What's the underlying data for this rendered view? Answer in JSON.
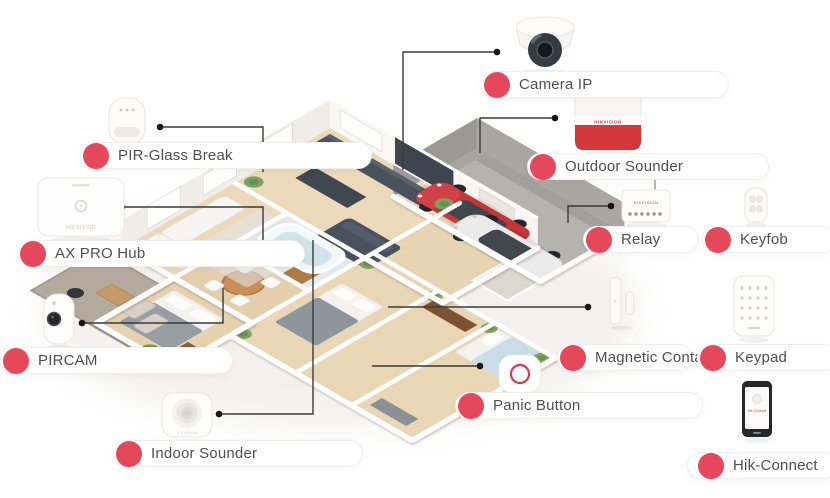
{
  "diagram": {
    "type": "smart-home-security-system-overview",
    "items": [
      {
        "id": "pir-glass-break",
        "label": "PIR-Glass Break",
        "icon": "motion-sensor-icon"
      },
      {
        "id": "ax-pro-hub",
        "label": "AX PRO Hub",
        "icon": "alarm-hub-icon",
        "brand": "HIKVISION"
      },
      {
        "id": "pircam",
        "label": "PIRCAM",
        "icon": "pir-camera-icon"
      },
      {
        "id": "indoor-sounder",
        "label": "Indoor Sounder",
        "icon": "indoor-siren-icon",
        "brand": "HIKVISION"
      },
      {
        "id": "camera-ip",
        "label": "Camera IP",
        "icon": "dome-camera-icon"
      },
      {
        "id": "outdoor-sounder",
        "label": "Outdoor Sounder",
        "icon": "outdoor-siren-icon",
        "brand": "HIKVISION"
      },
      {
        "id": "relay",
        "label": "Relay",
        "icon": "relay-module-icon",
        "brand": "HIKVISION"
      },
      {
        "id": "keyfob",
        "label": "Keyfob",
        "icon": "keyfob-remote-icon"
      },
      {
        "id": "magnetic-contact",
        "label": "Magnetic Contact",
        "icon": "door-magnet-icon"
      },
      {
        "id": "keypad",
        "label": "Keypad",
        "icon": "keypad-icon"
      },
      {
        "id": "panic-button",
        "label": "Panic Button",
        "icon": "panic-button-icon"
      },
      {
        "id": "hik-connect",
        "label": "Hik-Connect",
        "icon": "smartphone-app-icon",
        "screen_text": "Hik-Connect"
      }
    ],
    "colors": {
      "accent_red": "#e5485b",
      "connector_line": "#3a3a3a",
      "label_text": "#4f4f4f",
      "siren_red": "#d5383c",
      "car_red": "#c63538",
      "wood_floor": "#ead8b8",
      "garage_gray": "#b5b3b0",
      "wall_white": "#ffffff"
    }
  }
}
